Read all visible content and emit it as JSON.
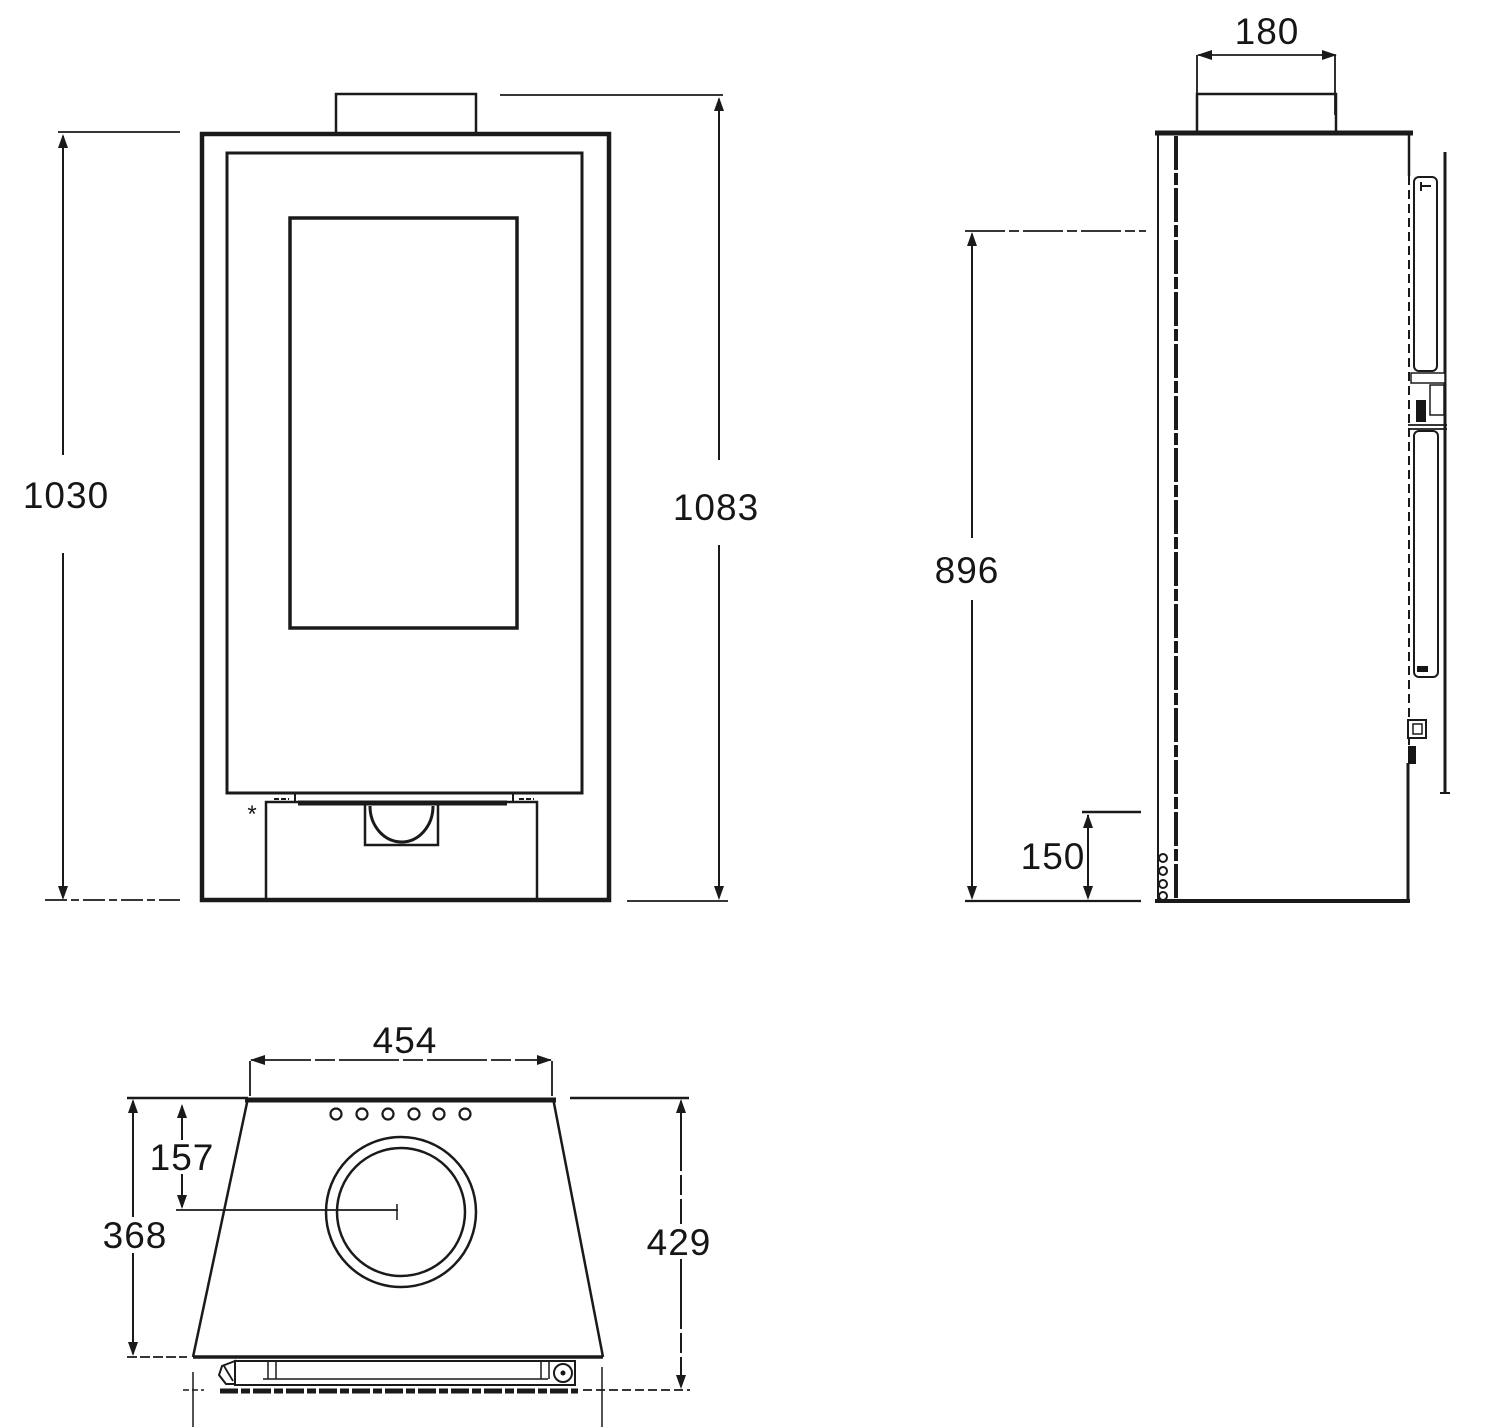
{
  "drawing": {
    "background_color": "#ffffff",
    "line_color": "#1a1a1a"
  },
  "dims": {
    "front_body_height": "1030",
    "front_total_height": "1083",
    "flue_collar_width": "180",
    "side_rear_height": "896",
    "side_outlet_height": "150",
    "top_rear_width": "454",
    "flue_center_offset": "157",
    "top_depth": "368",
    "top_front_depth": "429",
    "footnote_mark": "*"
  }
}
